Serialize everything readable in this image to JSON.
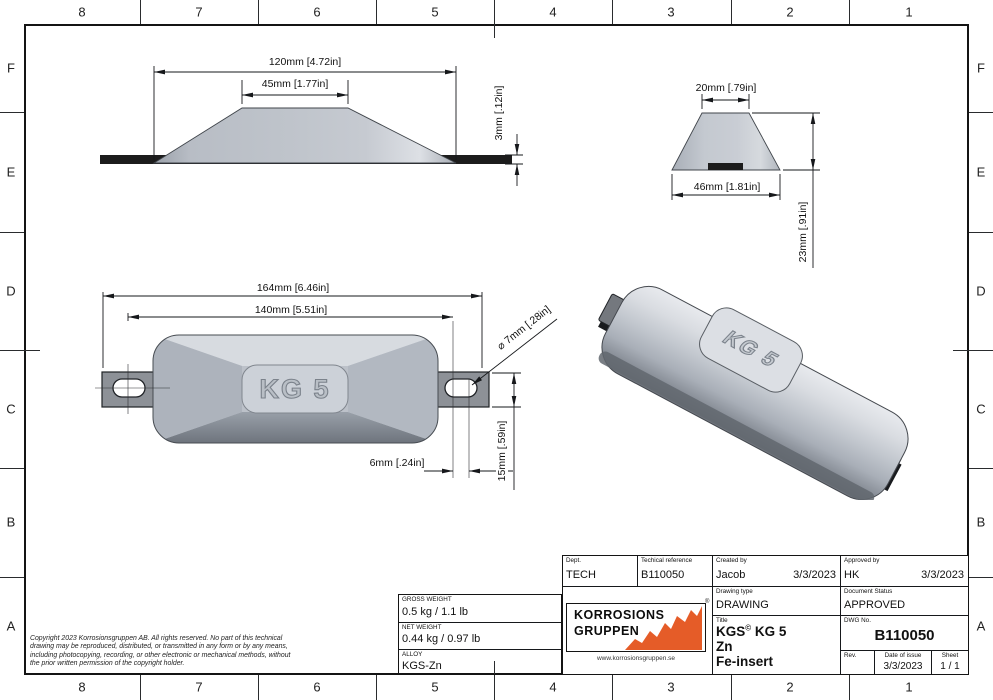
{
  "border": {
    "columns": [
      "8",
      "7",
      "6",
      "5",
      "4",
      "3",
      "2",
      "1"
    ],
    "rows": [
      "F",
      "E",
      "D",
      "C",
      "B",
      "A"
    ]
  },
  "front_view": {
    "width_dim": "120mm [4.72in]",
    "top_dim": "45mm [1.77in]",
    "thickness_dim": "3mm [.12in]"
  },
  "side_view": {
    "top_dim": "20mm [.79in]",
    "base_dim": "46mm [1.81in]",
    "height_dim": "23mm [.91in]"
  },
  "top_view": {
    "overall_dim": "164mm [6.46in]",
    "hole_spacing_dim": "140mm [5.51in]",
    "hole_dia_dim": "⌀ 7mm [.28in]",
    "slot_dim": "6mm [.24in]",
    "tab_dim": "15mm [.59in]",
    "product_label": "KG 5"
  },
  "iso_view": {
    "product_label": "KG 5"
  },
  "copyright": "Copyright 2023 Korrosionsgruppen AB. All rights reserved. No part of this technical\ndrawing may be reproduced, distributed, or transmitted in any form or by any means,\nincluding photocopying, recording, or other electronic or mechanical methods, without\nthe prior written permission of the copyright holder.",
  "weights": {
    "gross_label": "GROSS WEIGHT",
    "gross_value": "0.5 kg / 1.1 lb",
    "net_label": "NET WEIGHT",
    "net_value": "0.44 kg / 0.97 lb",
    "alloy_label": "ALLOY",
    "alloy_value": "KGS-Zn"
  },
  "logo": {
    "line1": "KORROSIONS",
    "line2": "GRUPPEN",
    "website": "www.korrosionsgruppen.se",
    "registered": "®",
    "accent_color": "#e55c28"
  },
  "title_block": {
    "dept_label": "Dept.",
    "dept_value": "TECH",
    "techref_label": "Techical reference",
    "techref_value": "B110050",
    "created_label": "Created by",
    "created_value": "Jacob",
    "created_date": "3/3/2023",
    "approved_label": "Approved by",
    "approved_value": "HK",
    "approved_date": "3/3/2023",
    "drawing_type_label": "Drawing type",
    "drawing_type_value": "DRAWING",
    "status_label": "Document Status",
    "status_value": "APPROVED",
    "title_label": "Title",
    "title_line1_name": "KGS",
    "title_line1_reg": "©",
    "title_line1_rest": " KG 5",
    "title_line2": "Zn",
    "title_line3": "Fe-insert",
    "dwg_label": "DWG No.",
    "dwg_value": "B110050",
    "rev_label": "Rev.",
    "rev_value": "",
    "date_label": "Date of issue",
    "date_value": "3/3/2023",
    "sheet_label": "Sheet",
    "sheet_value": "1 / 1"
  }
}
